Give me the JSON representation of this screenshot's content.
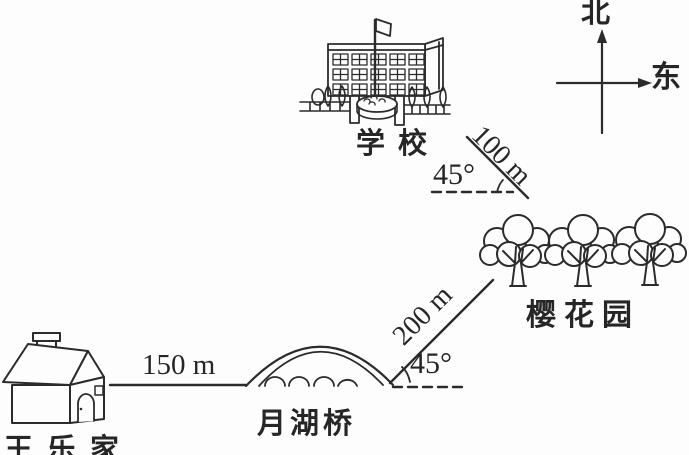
{
  "compass": {
    "north": "北",
    "east": "东"
  },
  "places": {
    "school": "学校",
    "garden": "樱花园",
    "bridge": "月湖桥",
    "house": "王乐家"
  },
  "distances": {
    "house_to_bridge": "150 m",
    "bridge_to_garden": "200 m",
    "garden_to_school": "100 m"
  },
  "angles": {
    "upper": "45°",
    "lower": "45°"
  },
  "icons": {
    "compass": "north-east-axes-icon",
    "school": "school-building-icon",
    "garden": "cherry-trees-icon",
    "bridge": "arch-bridge-icon",
    "house": "house-icon"
  },
  "colors": {
    "ink": "#2b2b2b",
    "background": "#fdfdfd"
  }
}
